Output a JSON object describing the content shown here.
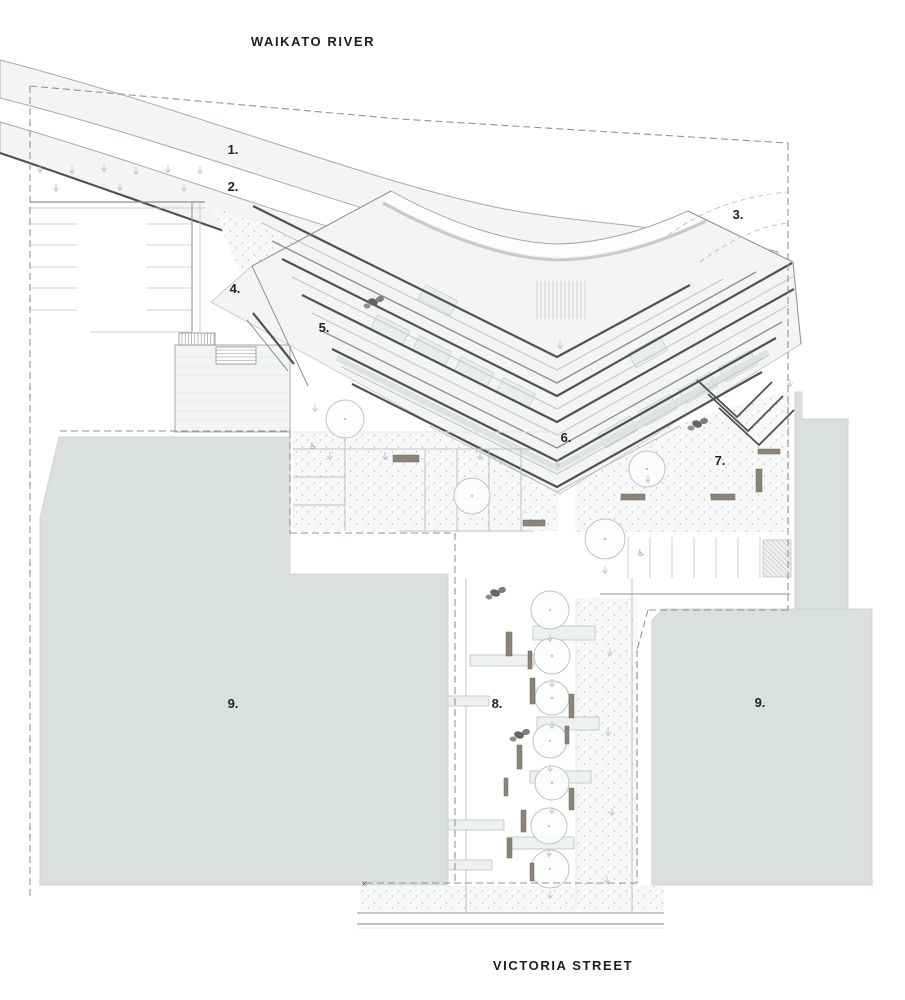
{
  "titles": {
    "river": "WAIKATO RIVER",
    "street": "VICTORIA STREET"
  },
  "labels": [
    {
      "text": "1.",
      "x": 233,
      "y": 154
    },
    {
      "text": "2.",
      "x": 233,
      "y": 191
    },
    {
      "text": "3.",
      "x": 738,
      "y": 219
    },
    {
      "text": "4.",
      "x": 235,
      "y": 293
    },
    {
      "text": "5.",
      "x": 324,
      "y": 332
    },
    {
      "text": "6.",
      "x": 566,
      "y": 442
    },
    {
      "text": "7.",
      "x": 720,
      "y": 465
    },
    {
      "text": "8.",
      "x": 497,
      "y": 708
    },
    {
      "text": "9.",
      "x": 233,
      "y": 708
    },
    {
      "text": "9.",
      "x": 760,
      "y": 707
    }
  ],
  "colors": {
    "ink": "#1f2124",
    "dark": "#4e5254",
    "mid": "#8b9092",
    "light": "#bfc3c5",
    "xlight": "#dfe2e3",
    "bandFill": "#f2f4f5",
    "bandEdge": "#a5aaac",
    "gray": "#dcdfe0",
    "grayEdge": "#d0d3d4",
    "stip": "#b4b8ba",
    "plaza": "#f7f8f8",
    "bench": "#8c8478",
    "blob": "#62665f",
    "blob2": "#7a7e76",
    "blob3": "#8d918a",
    "roof": "#eaeded",
    "roofEdge": "#c6cacb",
    "deck": "#eef1f1",
    "dash": "#8f9496",
    "white": "#ffffff"
  },
  "river": {
    "band1": "M0,60 C200,112 380,186 510,210 C600,226 672,224 778,252 L770,291 C672,262 598,258 505,245 C378,222 198,148 0,98 Z",
    "band2": "M0,122 C160,168 300,223 420,252 C470,264 505,271 548,278 L540,316 C498,307 462,300 412,290 C298,261 152,204 0,153 Z",
    "band2_edge": "M0,153 C152,204 298,261 412,290 C470,302 520,313 558,323"
  },
  "building": {
    "base": "M391,191 C452,225 512,243 557,244 C608,243 652,227 688,211 L793,262 L801,344 L560,494 L211,302 L252,266 Z",
    "canopy_fill": "M391,191 C452,225 512,243 557,244 C608,243 652,227 688,211 L704,219 C660,240 612,256 559,257 C505,256 445,234 383,200 Z",
    "canopy_outer": "M391,191 C452,225 512,243 557,244 C608,243 652,227 688,211",
    "canopy_inner": "M383,203 C445,237 505,259 559,260 C612,259 662,242 706,221",
    "hatch_zone": [
      537,
      281,
      52,
      38
    ],
    "chevrons": [
      {
        "pts": [
          [
            352,
            384
          ],
          [
            557,
            487
          ],
          [
            762,
            372
          ]
        ],
        "w": 2.2,
        "c": "dark"
      },
      {
        "pts": [
          [
            342,
            367
          ],
          [
            557,
            474
          ],
          [
            769,
            355
          ]
        ],
        "w": 1,
        "c": "light"
      },
      {
        "pts": [
          [
            332,
            349
          ],
          [
            557,
            461
          ],
          [
            776,
            338
          ]
        ],
        "w": 2.2,
        "c": "dark"
      },
      {
        "pts": [
          [
            322,
            331
          ],
          [
            557,
            448
          ],
          [
            782,
            322
          ]
        ],
        "w": 1.4,
        "c": "mid"
      },
      {
        "pts": [
          [
            312,
            313
          ],
          [
            557,
            435
          ],
          [
            789,
            305
          ]
        ],
        "w": 1,
        "c": "light"
      },
      {
        "pts": [
          [
            302,
            295
          ],
          [
            557,
            422
          ],
          [
            794,
            289
          ]
        ],
        "w": 2.2,
        "c": "dark"
      },
      {
        "pts": [
          [
            292,
            277
          ],
          [
            557,
            409
          ],
          [
            794,
            276
          ]
        ],
        "w": 1,
        "c": "light"
      },
      {
        "pts": [
          [
            282,
            259
          ],
          [
            557,
            396
          ],
          [
            792,
            263
          ]
        ],
        "w": 2.2,
        "c": "dark"
      },
      {
        "pts": [
          [
            272,
            241
          ],
          [
            557,
            383
          ],
          [
            756,
            272
          ]
        ],
        "w": 1.4,
        "c": "mid"
      },
      {
        "pts": [
          [
            262,
            223
          ],
          [
            557,
            370
          ],
          [
            723,
            279
          ]
        ],
        "w": 1,
        "c": "light"
      },
      {
        "pts": [
          [
            253,
            206
          ],
          [
            557,
            357
          ],
          [
            690,
            285
          ]
        ],
        "w": 2.2,
        "c": "dark"
      },
      {
        "pts": [
          [
            430,
            426
          ],
          [
            557,
            492
          ],
          [
            680,
            426
          ]
        ],
        "w": 1,
        "c": "light"
      }
    ],
    "mid_stripe": {
      "pts": [
        [
          337,
          358
        ],
        [
          557,
          468
        ],
        [
          768,
          352
        ]
      ],
      "w": 6,
      "c": "xlight"
    },
    "edges": [
      {
        "pts": [
          [
            252,
            266
          ],
          [
            391,
            191
          ]
        ],
        "w": 1,
        "c": "mid"
      },
      {
        "pts": [
          [
            252,
            266
          ],
          [
            308,
            386
          ]
        ],
        "w": 1,
        "c": "mid"
      },
      {
        "pts": [
          [
            688,
            211
          ],
          [
            793,
            262
          ]
        ],
        "w": 1,
        "c": "mid"
      },
      {
        "pts": [
          [
            793,
            262
          ],
          [
            801,
            344
          ]
        ],
        "w": 1,
        "c": "mid"
      },
      {
        "pts": [
          [
            253,
            313
          ],
          [
            294,
            364
          ]
        ],
        "w": 2.2,
        "c": "dark"
      },
      {
        "pts": [
          [
            247,
            320
          ],
          [
            288,
            371
          ]
        ],
        "w": 1,
        "c": "mid"
      }
    ],
    "nested": [
      {
        "pts": [
          [
            697,
            380
          ],
          [
            737,
            417
          ],
          [
            772,
            382
          ]
        ],
        "w": 1.8,
        "c": "dark"
      },
      {
        "pts": [
          [
            708,
            394
          ],
          [
            748,
            431
          ],
          [
            783,
            396
          ]
        ],
        "w": 1.8,
        "c": "dark"
      },
      {
        "pts": [
          [
            719,
            408
          ],
          [
            759,
            445
          ],
          [
            794,
            410
          ]
        ],
        "w": 1.8,
        "c": "dark"
      }
    ],
    "roof_rects": [
      {
        "x": 390,
        "y": 330,
        "deg": 27
      },
      {
        "x": 432,
        "y": 351,
        "deg": 27
      },
      {
        "x": 474,
        "y": 372,
        "deg": 27
      },
      {
        "x": 516,
        "y": 393,
        "deg": 27
      },
      {
        "x": 438,
        "y": 300,
        "deg": 27
      },
      {
        "x": 618,
        "y": 432,
        "deg": -29
      },
      {
        "x": 658,
        "y": 410,
        "deg": -29
      },
      {
        "x": 698,
        "y": 388,
        "deg": -29
      },
      {
        "x": 738,
        "y": 366,
        "deg": -29
      },
      {
        "x": 648,
        "y": 352,
        "deg": -29
      }
    ]
  },
  "stipples": [
    [
      [
        212,
        206
      ],
      [
        556,
        332
      ],
      [
        500,
        400
      ],
      [
        240,
        273
      ]
    ],
    [
      [
        575,
        455
      ],
      [
        790,
        390
      ],
      [
        790,
        532
      ],
      [
        575,
        532
      ]
    ],
    [
      [
        293,
        433
      ],
      [
        558,
        433
      ],
      [
        558,
        531
      ],
      [
        293,
        531
      ]
    ],
    [
      [
        576,
        598
      ],
      [
        638,
        598
      ],
      [
        638,
        908
      ],
      [
        576,
        908
      ]
    ],
    [
      [
        360,
        886
      ],
      [
        664,
        886
      ],
      [
        664,
        911
      ],
      [
        360,
        911
      ]
    ]
  ],
  "gray_blocks": [
    "M59,437 L290,437 L290,574 L448,574 L448,885 L40,885 L40,518 Z",
    "M795,392 L802,392 L802,419 L848,419 L848,609 L795,609 Z",
    "M663,609 L872,609 L872,885 L652,885 L652,620 Z"
  ],
  "parking_tl": {
    "frame": [
      {
        "pts": [
          [
            30,
            202
          ],
          [
            205,
            202
          ]
        ],
        "w": 1.2,
        "c": "mid"
      },
      {
        "pts": [
          [
            30,
            208
          ],
          [
            205,
            208
          ]
        ],
        "w": 0.8,
        "c": "light"
      },
      {
        "pts": [
          [
            192,
            202
          ],
          [
            192,
            332
          ]
        ],
        "w": 1,
        "c": "mid"
      },
      {
        "pts": [
          [
            200,
            202
          ],
          [
            200,
            332
          ]
        ],
        "w": 0.8,
        "c": "light"
      },
      {
        "pts": [
          [
            90,
            332
          ],
          [
            192,
            332
          ]
        ],
        "w": 0.8,
        "c": "light"
      }
    ],
    "stall_ys": [
      224,
      245,
      267,
      288,
      310
    ],
    "cols": [
      [
        30,
        77
      ],
      [
        146,
        192
      ]
    ]
  },
  "parking_r": {
    "xs": [
      628,
      650,
      672,
      694,
      716,
      738,
      760
    ],
    "y1": 537,
    "y2": 578,
    "aisle": {
      "pts": [
        [
          600,
          594
        ],
        [
          790,
          594
        ]
      ],
      "w": 1,
      "c": "mid"
    },
    "hatch": [
      763,
      540,
      28,
      37
    ]
  },
  "platform": {
    "rect": [
      175,
      345,
      115,
      87
    ],
    "stairs_v": [
      179,
      333,
      36,
      12
    ],
    "stairs_h": [
      216,
      347,
      40,
      17
    ]
  },
  "rooms": [
    {
      "pts": [
        [
          293,
          432
        ],
        [
          558,
          432
        ]
      ],
      "w": 1,
      "c": "xlight"
    },
    {
      "pts": [
        [
          293,
          449
        ],
        [
          530,
          449
        ]
      ],
      "w": 1,
      "c": "light"
    },
    {
      "pts": [
        [
          345,
          432
        ],
        [
          345,
          531
        ]
      ],
      "w": 1,
      "c": "light"
    },
    {
      "pts": [
        [
          425,
          449
        ],
        [
          425,
          531
        ]
      ],
      "w": 1,
      "c": "light"
    },
    {
      "pts": [
        [
          457,
          449
        ],
        [
          457,
          531
        ]
      ],
      "w": 1,
      "c": "light"
    },
    {
      "pts": [
        [
          489,
          449
        ],
        [
          489,
          531
        ]
      ],
      "w": 1,
      "c": "light"
    },
    {
      "pts": [
        [
          521,
          449
        ],
        [
          521,
          531
        ]
      ],
      "w": 1,
      "c": "light"
    },
    {
      "pts": [
        [
          293,
          477
        ],
        [
          345,
          477
        ]
      ],
      "w": 1,
      "c": "light"
    },
    {
      "pts": [
        [
          293,
          505
        ],
        [
          345,
          505
        ]
      ],
      "w": 1,
      "c": "light"
    },
    {
      "pts": [
        [
          400,
          531
        ],
        [
          533,
          531
        ]
      ],
      "w": 1,
      "c": "light"
    }
  ],
  "lane": {
    "walls": [
      {
        "pts": [
          [
            466,
            578
          ],
          [
            466,
            912
          ]
        ],
        "w": 1,
        "c": "light"
      },
      {
        "pts": [
          [
            632,
            578
          ],
          [
            632,
            912
          ]
        ],
        "w": 1,
        "c": "light"
      },
      {
        "pts": [
          [
            576,
            598
          ],
          [
            576,
            908
          ]
        ],
        "w": 0.8,
        "c": "xlight"
      }
    ],
    "decks": [
      [
        533,
        626,
        62,
        14
      ],
      [
        470,
        655,
        64,
        11
      ],
      [
        435,
        696,
        54,
        10
      ],
      [
        537,
        717,
        62,
        13
      ],
      [
        530,
        771,
        61,
        12
      ],
      [
        448,
        820,
        56,
        10
      ],
      [
        508,
        837,
        66,
        12
      ],
      [
        430,
        860,
        62,
        10
      ],
      [
        362,
        849,
        78,
        11
      ]
    ]
  },
  "trees": [
    [
      345,
      419,
      19
    ],
    [
      472,
      496,
      18
    ],
    [
      647,
      469,
      18
    ],
    [
      605,
      539,
      20
    ],
    [
      550,
      610,
      19
    ],
    [
      552,
      656,
      18
    ],
    [
      552,
      698,
      17
    ],
    [
      550,
      741,
      17
    ],
    [
      552,
      783,
      17
    ],
    [
      549,
      826,
      18
    ],
    [
      550,
      869,
      19
    ]
  ],
  "benches": [
    [
      393,
      455,
      26,
      7
    ],
    [
      523,
      520,
      22,
      6
    ],
    [
      621,
      494,
      24,
      6
    ],
    [
      711,
      494,
      24,
      6
    ],
    [
      756,
      469,
      6,
      23
    ],
    [
      758,
      449,
      22,
      5
    ],
    [
      506,
      632,
      6,
      24
    ],
    [
      528,
      651,
      4,
      18
    ],
    [
      530,
      678,
      5,
      26
    ],
    [
      569,
      694,
      5,
      24
    ],
    [
      565,
      726,
      4,
      18
    ],
    [
      517,
      745,
      5,
      24
    ],
    [
      504,
      778,
      4,
      18
    ],
    [
      569,
      788,
      5,
      22
    ],
    [
      521,
      810,
      5,
      22
    ],
    [
      507,
      838,
      5,
      20
    ],
    [
      530,
      863,
      4,
      18
    ]
  ],
  "blobs": [
    [
      373,
      302
    ],
    [
      697,
      424
    ],
    [
      495,
      593
    ],
    [
      519,
      735
    ]
  ],
  "arrows": {
    "grass": [
      [
        40,
        169
      ],
      [
        72,
        170
      ],
      [
        104,
        168
      ],
      [
        136,
        171
      ],
      [
        168,
        169
      ],
      [
        200,
        170
      ],
      [
        56,
        188
      ],
      [
        120,
        187
      ],
      [
        184,
        188
      ]
    ],
    "plaza": [
      [
        330,
        456
      ],
      [
        385,
        456
      ],
      [
        480,
        456
      ],
      [
        558,
        463
      ],
      [
        648,
        479
      ],
      [
        790,
        383
      ],
      [
        560,
        345
      ],
      [
        315,
        408
      ]
    ],
    "lane": [
      [
        550,
        638
      ],
      [
        552,
        683
      ],
      [
        552,
        725
      ],
      [
        550,
        768
      ],
      [
        552,
        810
      ],
      [
        549,
        853
      ],
      [
        550,
        895
      ],
      [
        610,
        652
      ],
      [
        608,
        732
      ],
      [
        612,
        812
      ],
      [
        607,
        880
      ],
      [
        605,
        570
      ]
    ]
  },
  "dashes": [
    [
      [
        30,
        86
      ],
      [
        400,
        119
      ],
      [
        788,
        143
      ]
    ],
    [
      [
        30,
        86
      ],
      [
        30,
        900
      ]
    ],
    [
      [
        788,
        143
      ],
      [
        788,
        610
      ]
    ],
    [
      [
        788,
        610
      ],
      [
        648,
        610
      ]
    ],
    [
      [
        648,
        610
      ],
      [
        637,
        650
      ]
    ],
    [
      [
        637,
        650
      ],
      [
        637,
        883
      ]
    ],
    [
      [
        637,
        883
      ],
      [
        364,
        883
      ]
    ],
    [
      [
        60,
        431
      ],
      [
        290,
        431
      ]
    ],
    [
      [
        290,
        431
      ],
      [
        290,
        533
      ]
    ],
    [
      [
        290,
        533
      ],
      [
        455,
        533
      ]
    ],
    [
      [
        455,
        533
      ],
      [
        455,
        883
      ]
    ]
  ],
  "path3_curves": [
    "M668,235 C700,212 740,196 788,192",
    "M700,262 C730,240 760,226 788,223"
  ],
  "street_lines": [
    {
      "pts": [
        [
          357,
          913
        ],
        [
          664,
          913
        ]
      ],
      "w": 1,
      "c": "mid"
    },
    {
      "pts": [
        [
          357,
          924
        ],
        [
          664,
          924
        ]
      ],
      "w": 2,
      "c": "light"
    },
    {
      "pts": [
        [
          357,
          928
        ],
        [
          664,
          928
        ]
      ],
      "w": 0.8,
      "c": "xlight"
    }
  ],
  "symbols": {
    "wheelchair": [
      [
        641,
        556
      ],
      [
        313,
        449
      ]
    ],
    "xmark": [
      361,
      886
    ]
  }
}
